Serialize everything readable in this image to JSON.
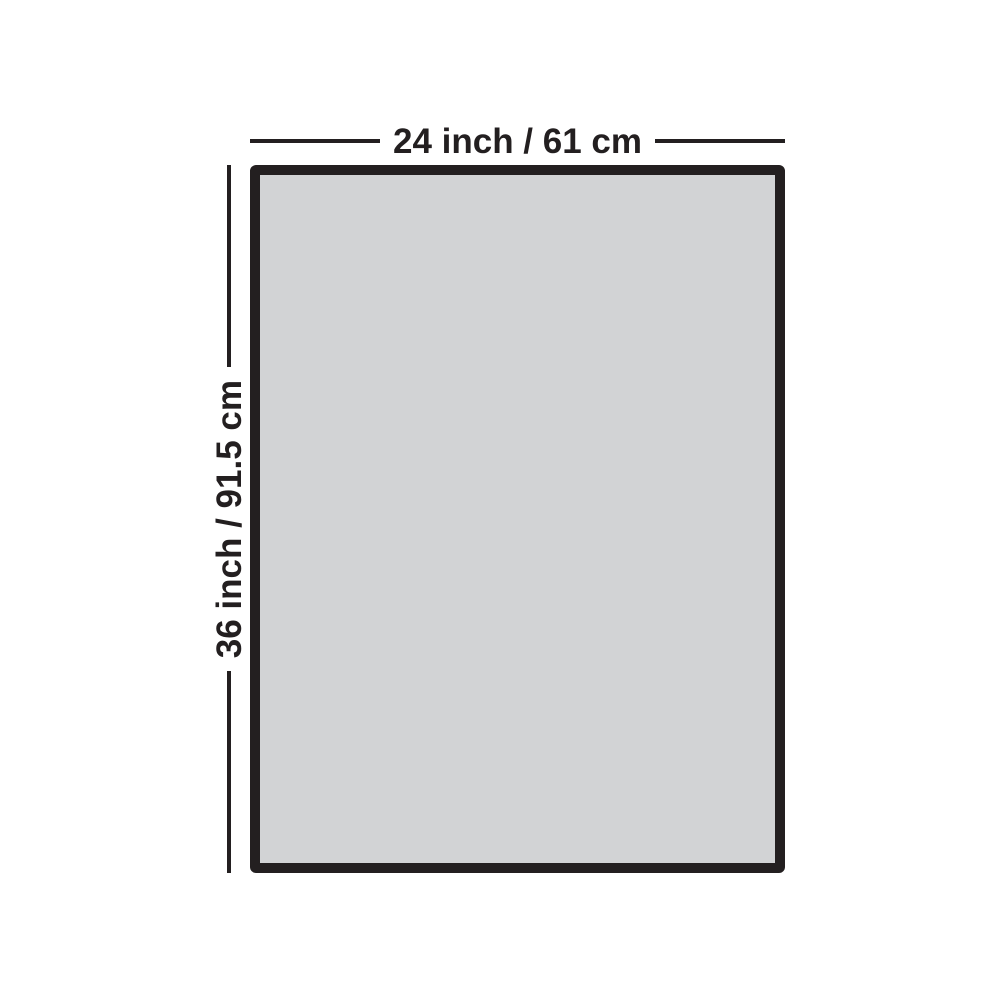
{
  "diagram": {
    "width_label": "24 inch / 61 cm",
    "height_label": "36 inch / 91.5 cm",
    "colors": {
      "outline": "#231f20",
      "panel_fill": "#d2d3d5",
      "page_background": "#ffffff"
    }
  }
}
